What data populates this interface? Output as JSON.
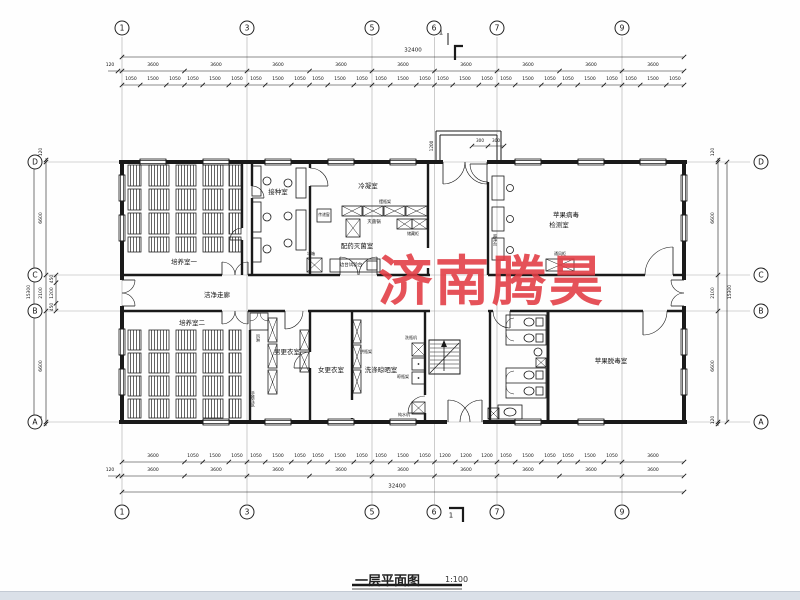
{
  "drawing": {
    "title": "一层平面图",
    "scale": "1:100",
    "watermark": {
      "text": "济南腾昊",
      "color": "#e23b43"
    },
    "footer_bar_color": "#dae0e8"
  },
  "axis_bubbles": {
    "top": [
      {
        "label": "1",
        "x": 122,
        "y": 28
      },
      {
        "label": "3",
        "x": 247,
        "y": 28
      },
      {
        "label": "5",
        "x": 372,
        "y": 28
      },
      {
        "label": "6",
        "x": 434,
        "y": 28
      },
      {
        "label": "7",
        "x": 497,
        "y": 28
      },
      {
        "label": "9",
        "x": 622,
        "y": 28
      }
    ],
    "bottom": [
      {
        "label": "1",
        "x": 122,
        "y": 512
      },
      {
        "label": "3",
        "x": 247,
        "y": 512
      },
      {
        "label": "5",
        "x": 372,
        "y": 512
      },
      {
        "label": "6",
        "x": 434,
        "y": 512
      },
      {
        "label": "7",
        "x": 497,
        "y": 512
      },
      {
        "label": "9",
        "x": 622,
        "y": 512
      }
    ],
    "left": [
      {
        "label": "D",
        "x": 35,
        "y": 162
      },
      {
        "label": "C",
        "x": 35,
        "y": 275
      },
      {
        "label": "B",
        "x": 35,
        "y": 311
      },
      {
        "label": "A",
        "x": 35,
        "y": 422
      }
    ],
    "right": [
      {
        "label": "D",
        "x": 761,
        "y": 162
      },
      {
        "label": "C",
        "x": 761,
        "y": 275
      },
      {
        "label": "B",
        "x": 761,
        "y": 311
      },
      {
        "label": "A",
        "x": 761,
        "y": 422
      }
    ]
  },
  "section_marks": [
    {
      "t": "1",
      "x": 441,
      "y": 33
    },
    {
      "t": "1",
      "x": 451,
      "y": 516
    }
  ],
  "dim_labels_top": [
    {
      "t": "32400",
      "x": 413,
      "y": 51,
      "s": 5.5
    },
    {
      "t": "120",
      "x": 110,
      "y": 66
    },
    {
      "t": "3600",
      "x": 153,
      "y": 66
    },
    {
      "t": "3600",
      "x": 216,
      "y": 66
    },
    {
      "t": "3600",
      "x": 278,
      "y": 66
    },
    {
      "t": "3600",
      "x": 341,
      "y": 66
    },
    {
      "t": "3600",
      "x": 403,
      "y": 66
    },
    {
      "t": "3600",
      "x": 466,
      "y": 66
    },
    {
      "t": "3600",
      "x": 528,
      "y": 66
    },
    {
      "t": "3600",
      "x": 591,
      "y": 66
    },
    {
      "t": "3600",
      "x": 653,
      "y": 66
    },
    {
      "t": "1050",
      "x": 131,
      "y": 80
    },
    {
      "t": "1500",
      "x": 153,
      "y": 80
    },
    {
      "t": "1050",
      "x": 175,
      "y": 80
    },
    {
      "t": "1050",
      "x": 193,
      "y": 80
    },
    {
      "t": "1500",
      "x": 215,
      "y": 80
    },
    {
      "t": "1050",
      "x": 237,
      "y": 80
    },
    {
      "t": "1050",
      "x": 256,
      "y": 80
    },
    {
      "t": "1500",
      "x": 278,
      "y": 80
    },
    {
      "t": "1050",
      "x": 300,
      "y": 80
    },
    {
      "t": "1050",
      "x": 318,
      "y": 80
    },
    {
      "t": "1500",
      "x": 340,
      "y": 80
    },
    {
      "t": "1050",
      "x": 362,
      "y": 80
    },
    {
      "t": "1050",
      "x": 381,
      "y": 80
    },
    {
      "t": "1500",
      "x": 403,
      "y": 80
    },
    {
      "t": "1050",
      "x": 425,
      "y": 80
    },
    {
      "t": "1050",
      "x": 443,
      "y": 80
    },
    {
      "t": "1500",
      "x": 465,
      "y": 80
    },
    {
      "t": "1050",
      "x": 487,
      "y": 80
    },
    {
      "t": "1050",
      "x": 506,
      "y": 80
    },
    {
      "t": "1500",
      "x": 528,
      "y": 80
    },
    {
      "t": "1050",
      "x": 550,
      "y": 80
    },
    {
      "t": "1050",
      "x": 568,
      "y": 80
    },
    {
      "t": "1500",
      "x": 590,
      "y": 80
    },
    {
      "t": "1050",
      "x": 612,
      "y": 80
    },
    {
      "t": "1050",
      "x": 631,
      "y": 80
    },
    {
      "t": "1500",
      "x": 653,
      "y": 80
    },
    {
      "t": "1050",
      "x": 675,
      "y": 80
    }
  ],
  "dim_labels_bottom": [
    {
      "t": "3600",
      "x": 153,
      "y": 457
    },
    {
      "t": "1050",
      "x": 193,
      "y": 457
    },
    {
      "t": "1500",
      "x": 215,
      "y": 457
    },
    {
      "t": "1050",
      "x": 237,
      "y": 457
    },
    {
      "t": "1050",
      "x": 256,
      "y": 457
    },
    {
      "t": "1500",
      "x": 278,
      "y": 457
    },
    {
      "t": "1050",
      "x": 300,
      "y": 457
    },
    {
      "t": "1050",
      "x": 318,
      "y": 457
    },
    {
      "t": "1500",
      "x": 340,
      "y": 457
    },
    {
      "t": "1050",
      "x": 362,
      "y": 457
    },
    {
      "t": "1050",
      "x": 381,
      "y": 457
    },
    {
      "t": "1500",
      "x": 403,
      "y": 457
    },
    {
      "t": "1050",
      "x": 425,
      "y": 457
    },
    {
      "t": "1200",
      "x": 445,
      "y": 457
    },
    {
      "t": "1200",
      "x": 466,
      "y": 457
    },
    {
      "t": "1200",
      "x": 487,
      "y": 457
    },
    {
      "t": "1050",
      "x": 506,
      "y": 457
    },
    {
      "t": "1500",
      "x": 528,
      "y": 457
    },
    {
      "t": "1050",
      "x": 550,
      "y": 457
    },
    {
      "t": "1050",
      "x": 568,
      "y": 457
    },
    {
      "t": "1500",
      "x": 590,
      "y": 457
    },
    {
      "t": "1050",
      "x": 612,
      "y": 457
    },
    {
      "t": "3600",
      "x": 653,
      "y": 457
    },
    {
      "t": "120",
      "x": 110,
      "y": 471
    },
    {
      "t": "3600",
      "x": 153,
      "y": 471
    },
    {
      "t": "3600",
      "x": 216,
      "y": 471
    },
    {
      "t": "3600",
      "x": 278,
      "y": 471
    },
    {
      "t": "3600",
      "x": 341,
      "y": 471
    },
    {
      "t": "3600",
      "x": 403,
      "y": 471
    },
    {
      "t": "3600",
      "x": 466,
      "y": 471
    },
    {
      "t": "3600",
      "x": 528,
      "y": 471
    },
    {
      "t": "3600",
      "x": 591,
      "y": 471
    },
    {
      "t": "3600",
      "x": 653,
      "y": 471
    },
    {
      "t": "32400",
      "x": 397,
      "y": 487,
      "s": 5.5
    }
  ],
  "dim_labels_left": [
    {
      "t": "120",
      "x": 42,
      "y": 152,
      "r": -90
    },
    {
      "t": "6600",
      "x": 42,
      "y": 218,
      "r": -90
    },
    {
      "t": "450",
      "x": 53,
      "y": 279,
      "r": -90
    },
    {
      "t": "1200",
      "x": 53,
      "y": 293,
      "r": -90
    },
    {
      "t": "450",
      "x": 53,
      "y": 307,
      "r": -90
    },
    {
      "t": "2100",
      "x": 42,
      "y": 293,
      "r": -90
    },
    {
      "t": "15300",
      "x": 30,
      "y": 292,
      "r": -90
    },
    {
      "t": "6600",
      "x": 42,
      "y": 366,
      "r": -90
    },
    {
      "t": "120",
      "x": 42,
      "y": 420,
      "r": -90
    }
  ],
  "dim_labels_right": [
    {
      "t": "120",
      "x": 714,
      "y": 152,
      "r": -90
    },
    {
      "t": "6600",
      "x": 714,
      "y": 218,
      "r": -90
    },
    {
      "t": "2100",
      "x": 714,
      "y": 293,
      "r": -90
    },
    {
      "t": "15300",
      "x": 731,
      "y": 292,
      "r": -90
    },
    {
      "t": "6600",
      "x": 714,
      "y": 366,
      "r": -90
    },
    {
      "t": "120",
      "x": 714,
      "y": 420,
      "r": -90
    }
  ],
  "dim_labels_porch": [
    {
      "t": "1200",
      "x": 432,
      "y": 146,
      "r": -90
    },
    {
      "t": "300",
      "x": 480,
      "y": 141
    },
    {
      "t": "300",
      "x": 496,
      "y": 141
    }
  ],
  "rooms": [
    {
      "t": "培养室一",
      "x": 184,
      "y": 262,
      "n": "room-cultivation-1"
    },
    {
      "t": "培养室二",
      "x": 192,
      "y": 323,
      "n": "room-cultivation-2"
    },
    {
      "t": "接种室",
      "x": 278,
      "y": 192,
      "n": "room-inoculation"
    },
    {
      "t": "冷凝室",
      "x": 368,
      "y": 186,
      "n": "room-condensation"
    },
    {
      "t": "配药灭菌室",
      "x": 357,
      "y": 246,
      "n": "room-dispensing-sterilization"
    },
    {
      "t": "苹果病毒",
      "x": 566,
      "y": 215,
      "n": "room-apple-virus-line1"
    },
    {
      "t": "检测室",
      "x": 559,
      "y": 225,
      "n": "room-apple-virus-line2"
    },
    {
      "t": "洁净走廊",
      "x": 217,
      "y": 295,
      "n": "clean-corridor"
    },
    {
      "t": "男更衣室",
      "x": 287,
      "y": 352,
      "n": "room-men-changing"
    },
    {
      "t": "女更衣室",
      "x": 331,
      "y": 370,
      "n": "room-women-changing"
    },
    {
      "t": "洗涤晾晒室",
      "x": 381,
      "y": 370,
      "n": "room-washing-drying"
    },
    {
      "t": "苹果脱毒室",
      "x": 611,
      "y": 361,
      "n": "room-apple-detox"
    }
  ],
  "equipment": [
    {
      "t": "摆瓶架",
      "x": 385,
      "y": 202,
      "s": 4,
      "n": "bottle-shelf"
    },
    {
      "t": "灭菌锅",
      "x": 374,
      "y": 223,
      "s": 4.5,
      "n": "sterilizer"
    },
    {
      "t": "储藏柜",
      "x": 413,
      "y": 234,
      "s": 4,
      "n": "storage-cabinet"
    },
    {
      "t": "边台试验台",
      "x": 351,
      "y": 266,
      "s": 4.5,
      "n": "side-test-bench"
    },
    {
      "t": "传递窗",
      "x": 324,
      "y": 215,
      "s": 3.8,
      "n": "pass-through-window"
    },
    {
      "t": "冰箱",
      "x": 311,
      "y": 254,
      "s": 4,
      "n": "refrigerator"
    },
    {
      "t": "超净台",
      "x": 495,
      "y": 240,
      "s": 4,
      "v": 1,
      "n": "clean-bench"
    },
    {
      "t": "通风柜",
      "x": 560,
      "y": 254,
      "s": 4,
      "n": "fume-hood"
    },
    {
      "t": "风淋",
      "x": 258,
      "y": 338,
      "s": 4,
      "v": 1,
      "n": "air-shower"
    },
    {
      "t": "手推车区",
      "x": 253,
      "y": 399,
      "s": 4,
      "v": 1,
      "n": "cart-area"
    },
    {
      "t": "烘瓶架",
      "x": 366,
      "y": 352,
      "s": 4,
      "n": "bottle-drying-rack-1"
    },
    {
      "t": "洗瓶机",
      "x": 411,
      "y": 338,
      "s": 4,
      "n": "bottle-washer"
    },
    {
      "t": "晾瓶架",
      "x": 403,
      "y": 377,
      "s": 4,
      "n": "bottle-drying-rack-2"
    },
    {
      "t": "纯水机",
      "x": 404,
      "y": 415,
      "s": 4,
      "n": "pure-water-machine"
    }
  ]
}
